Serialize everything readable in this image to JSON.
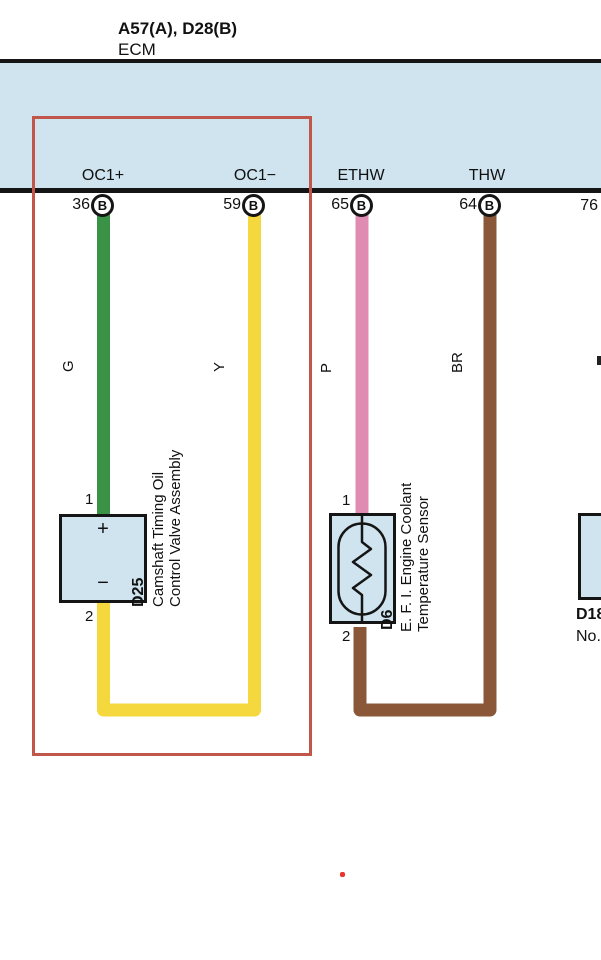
{
  "header": {
    "connectors": "A57(A), D28(B)",
    "module": "ECM"
  },
  "colors": {
    "band": "#cfe4ee",
    "component_fill": "#cfe4ee",
    "highlight": "#c1574b",
    "dot": "#e8362a",
    "wire_green": "#3a9247",
    "wire_yellow": "#f4d83e",
    "wire_pink": "#e08bb2",
    "wire_brown": "#8a5838",
    "line_black": "#151515"
  },
  "pins": [
    {
      "label": "OC1+",
      "number": "36",
      "connector": "B",
      "wire_code": "G"
    },
    {
      "label": "OC1−",
      "number": "59",
      "connector": "B",
      "wire_code": "Y"
    },
    {
      "label": "ETHW",
      "number": "65",
      "connector": "B",
      "wire_code": "P"
    },
    {
      "label": "THW",
      "number": "64",
      "connector": "B",
      "wire_code": "BR"
    },
    {
      "label": "",
      "number": "76",
      "connector": "",
      "wire_code": ""
    }
  ],
  "components": {
    "d25": {
      "id": "D25",
      "pin_top": "1",
      "pin_bottom": "2",
      "plus": "+",
      "minus": "−",
      "name_line1": "Camshaft Timing Oil",
      "name_line2": "Control Valve Assembly"
    },
    "d6": {
      "id": "D6",
      "pin_top": "1",
      "pin_bottom": "2",
      "name_line1": "E. F. I.  Engine Coolant",
      "name_line2": "Temperature Sensor"
    },
    "d18": {
      "id": "D18",
      "name_partial": "No."
    }
  }
}
